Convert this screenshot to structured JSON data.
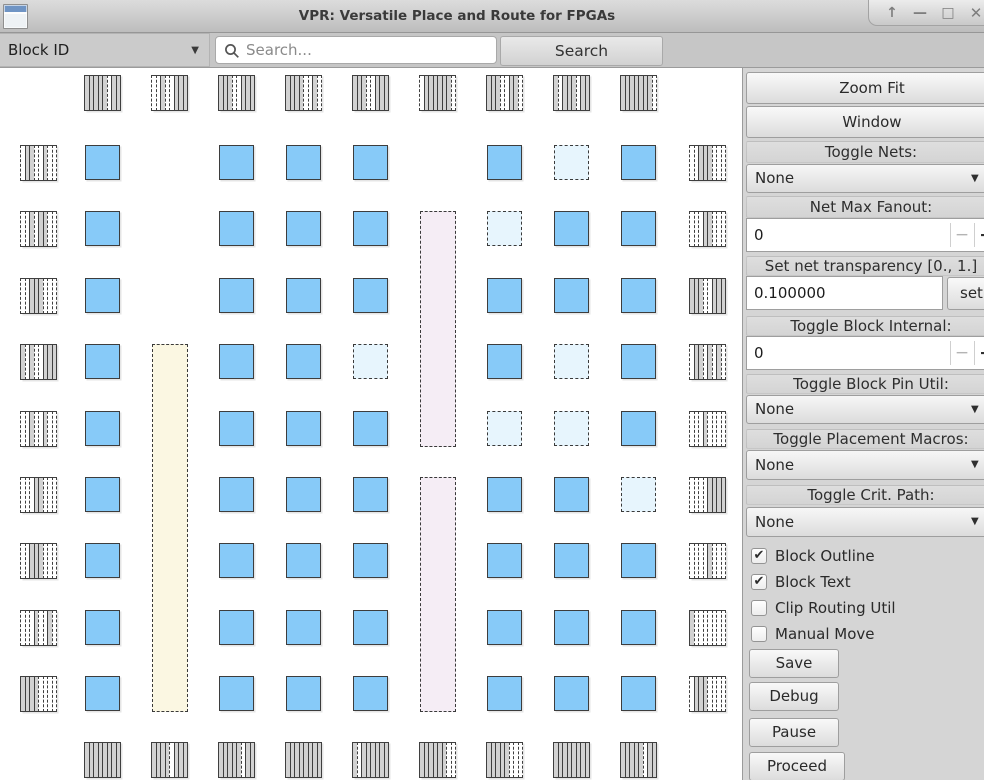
{
  "window": {
    "title": "VPR: Versatile Place and Route for FPGAs",
    "control_glyphs": {
      "shade": "↑",
      "minimize": "—",
      "maximize": "□",
      "close": "✕"
    }
  },
  "toolbar": {
    "block_id_label": "Block ID",
    "combo_arrow": "▼",
    "search_placeholder": "Search...",
    "search_button": "Search"
  },
  "sidebar": {
    "zoom_fit": "Zoom Fit",
    "window_btn": "Window",
    "toggle_nets_label": "Toggle Nets:",
    "toggle_nets_value": "None",
    "net_max_fanout_label": "Net Max Fanout:",
    "net_max_fanout_value": "0",
    "transparency_label": "Set net transparency [0., 1.]",
    "transparency_value": "0.100000",
    "set_button": "set",
    "block_internal_label": "Toggle Block Internal:",
    "block_internal_value": "0",
    "pin_util_label": "Toggle Block Pin Util:",
    "pin_util_value": "None",
    "macros_label": "Toggle Placement Macros:",
    "macros_value": "None",
    "crit_path_label": "Toggle Crit. Path:",
    "crit_path_value": "None",
    "combo_arrow": "▼",
    "spinner_minus": "−",
    "spinner_plus": "+",
    "checkboxes": [
      {
        "label": "Block Outline",
        "checked": true
      },
      {
        "label": "Block Text",
        "checked": true
      },
      {
        "label": "Clip Routing Util",
        "checked": false
      },
      {
        "label": "Manual Move",
        "checked": false
      }
    ],
    "action_buttons": [
      "Save",
      "Debug",
      "Pause",
      "Proceed"
    ]
  },
  "canvas": {
    "colors": {
      "clb": "#87caf8",
      "clb_border": "#3d3d3d",
      "empty": "#e7f5fd",
      "macro_yellow": "#fbf7e2",
      "macro_purple": "#f5edf5",
      "io_fill": "#d2d2d2",
      "io_border": "#3f3f3f"
    },
    "grid": {
      "block": 36,
      "col_x": [
        85,
        152,
        219,
        286,
        353,
        420,
        487,
        554,
        621
      ],
      "row_y": [
        77,
        143,
        210,
        276,
        343,
        409,
        475,
        542,
        608
      ],
      "io_left_x": 21,
      "io_right_x": 690,
      "io_top_y": 7,
      "io_bottom_y": 674
    },
    "cells": [
      "B.BBB.BEB",
      "B.BBB.EBB",
      "B.BBB.BBB",
      "B.BBE.BEB",
      "B.BBB.EEB",
      "B.BBB.BBE",
      "B.BBB.BBB",
      "B.BBB.BBB",
      "B.BBB.BBB"
    ],
    "macros": [
      {
        "col": 2,
        "row_start": 4,
        "row_end": 9,
        "color_key": "macro_yellow"
      },
      {
        "col": 6,
        "row_start": 2,
        "row_end": 5,
        "color_key": "macro_purple"
      },
      {
        "col": 6,
        "row_start": 6,
        "row_end": 9,
        "color_key": "macro_purple"
      }
    ],
    "io": {
      "top": [
        "FFFFFEFF",
        "EEFEEFFF",
        "FFFEEFFF",
        "FFFFEEFE",
        "FFFEEFFF",
        "EFFFFFFE",
        "FFFEEFFE",
        "FEFFFEFF",
        "FFFFFFFE"
      ],
      "bottom": [
        "FFFFFFFF",
        "FFFFEFFF",
        "FFFFFEFF",
        "FFFFFFFF",
        "FEFFFFFF",
        "FFFFFFEE",
        "FFFFFEEE",
        "FFFFFFFF",
        "FFFFFEFF"
      ],
      "left": [
        "EFFEEFEE",
        "EEFEFFEE",
        "EEFFFEEE",
        "FEFEEFFF",
        "EEFEEFEE",
        "EEEFFEEE",
        "EEFFFEEE",
        "EEEFEEFE",
        "FFFFEEEE"
      ],
      "right": [
        "EEFFFEEE",
        "EEEFFEEE",
        "FFFEEFFF",
        "EFFEFEFE",
        "EEEFEEEE",
        "EEEEFFFF",
        "EEEEFEEE",
        "FEEEEEEE",
        "EFFFEEEE"
      ]
    }
  }
}
